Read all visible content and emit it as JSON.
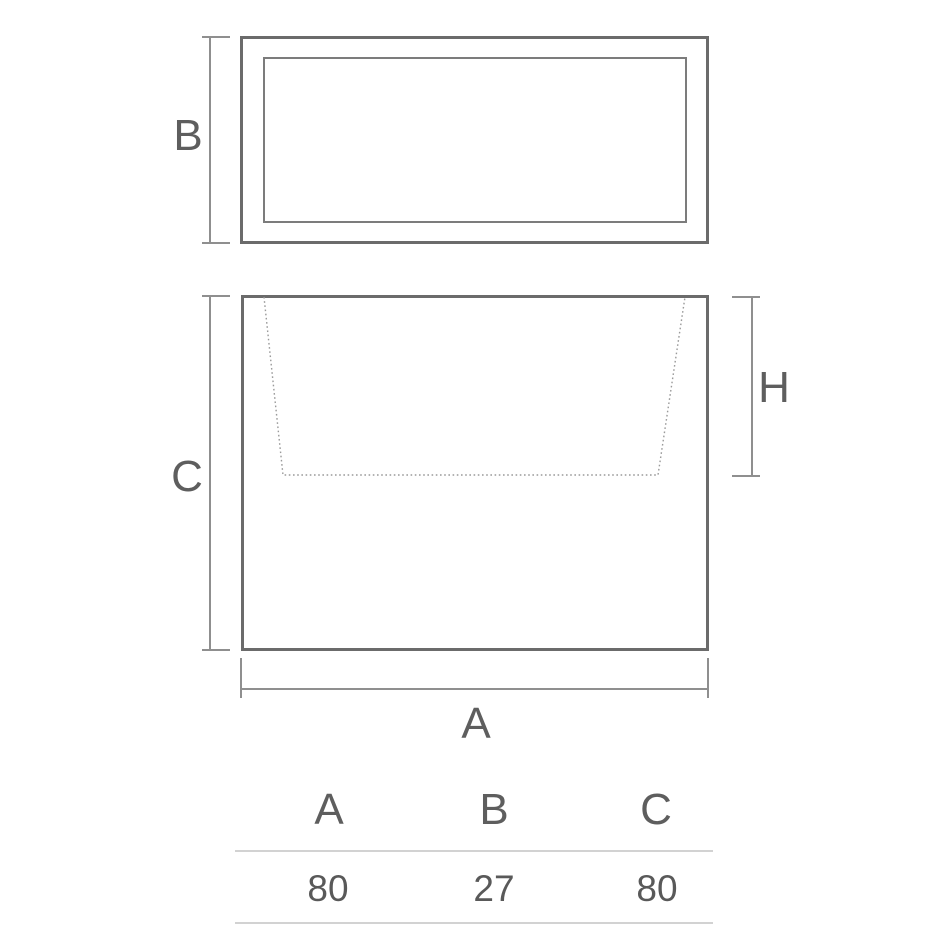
{
  "drawing": {
    "top_view": {
      "dim_label": "B"
    },
    "front_view": {
      "height_label": "C",
      "cavity_depth_label": "H",
      "width_label": "A"
    }
  },
  "table": {
    "columns": [
      "A",
      "B",
      "C"
    ],
    "values": [
      "80",
      "27",
      "80"
    ]
  },
  "colors": {
    "outline": "#6b6b6b",
    "inner_outline": "#7c7c7c",
    "dimension": "#8f8f8f",
    "dashed": "#9a9a9a",
    "text": "#5e5e5e",
    "table_rule": "#d2d2d2"
  }
}
